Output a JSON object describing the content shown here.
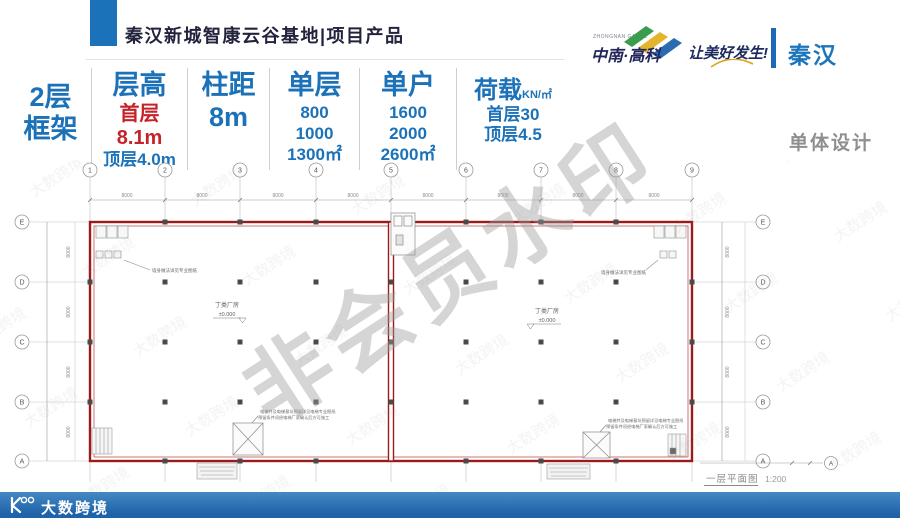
{
  "header": {
    "title": "秦汉新城智康云谷基地|项目产品",
    "brand_en": "ZHONGNAN GAOKE",
    "brand": "中南·高科",
    "slogan": "让美好发生!",
    "region": "秦汉"
  },
  "specs": {
    "structure_l1": "2层",
    "structure_l2": "框架",
    "floor_height_label": "层高",
    "floor_height_first": "首层8.1m",
    "floor_height_top": "顶层4.0m",
    "column_span_label": "柱距",
    "column_span_value": "8m",
    "single_floor_label": "单层",
    "single_floor_v1": "800",
    "single_floor_v2": "1000",
    "single_floor_v3": "1300㎡",
    "single_unit_label": "单户",
    "single_unit_v1": "1600",
    "single_unit_v2": "2000",
    "single_unit_v3": "2600㎡",
    "load_label": "荷载",
    "load_unit": "KN/㎡",
    "load_first": "首层30",
    "load_top": "顶层4.5"
  },
  "section_label": "单体设计",
  "plan": {
    "column_bubbles": [
      "1",
      "2",
      "3",
      "4",
      "5",
      "6",
      "7",
      "8",
      "9"
    ],
    "row_bubbles": [
      "E",
      "D",
      "C",
      "B",
      "A"
    ],
    "bay_dim": "8000",
    "unit_label": "丁类厂房",
    "level": "±0.000",
    "annotation_top_left": "墙身做法详见专业图纸",
    "annotation_top_right": "墙身做法详见专业图纸",
    "annotation_bottom_l1": "电梯井及电梯基坑预留详见电梯专业图纸",
    "annotation_bottom_l2": "预留条件须经电梯厂家确认后方可施工",
    "caption": "一层平面图",
    "scale": "1:200",
    "watermark": "非会员水印",
    "row_end_bubble": "A"
  },
  "footer": {
    "logo_text": "大数跨境"
  }
}
